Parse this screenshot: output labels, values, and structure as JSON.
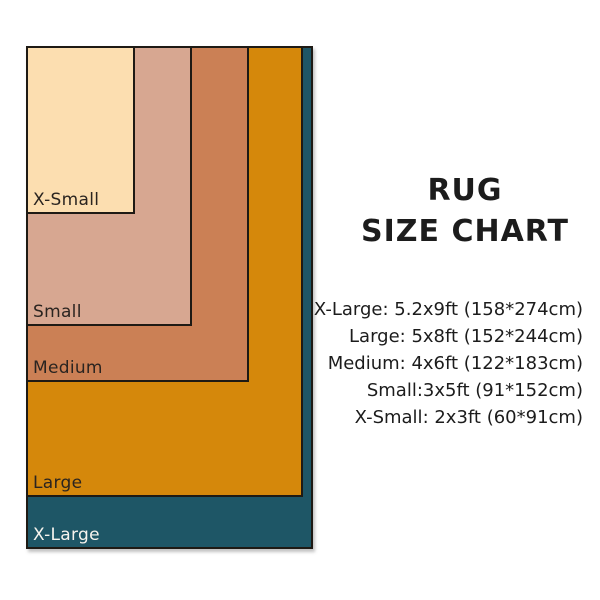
{
  "background": "#ffffff",
  "border_color": "#1e1a14",
  "text_color": "#1c1c1c",
  "title": {
    "line1": "RUG",
    "line2": "SIZE CHART"
  },
  "rugs": [
    {
      "label": "X-Large",
      "fill": "#1E5666",
      "label_color": "#F7F4EE",
      "x": 26,
      "y": 46,
      "w": 287,
      "h": 503
    },
    {
      "label": "Large",
      "fill": "#D5880B",
      "label_color": "#2A2420",
      "x": 26,
      "y": 46,
      "w": 277,
      "h": 451
    },
    {
      "label": "Medium",
      "fill": "#CB8055",
      "label_color": "#2A2420",
      "x": 26,
      "y": 46,
      "w": 223,
      "h": 336
    },
    {
      "label": "Small",
      "fill": "#D7A791",
      "label_color": "#2A2420",
      "x": 26,
      "y": 46,
      "w": 166,
      "h": 280
    },
    {
      "label": "X-Small",
      "fill": "#FCDEB0",
      "label_color": "#2A2420",
      "x": 26,
      "y": 46,
      "w": 109,
      "h": 168
    }
  ],
  "specs": [
    "X-Large: 5.2x9ft (158*274cm)",
    "Large: 5x8ft (152*244cm)",
    "Medium: 4x6ft (122*183cm)",
    "Small:3x5ft (91*152cm)",
    "X-Small: 2x3ft (60*91cm)"
  ],
  "chart_data": {
    "type": "area",
    "title": "RUG SIZE CHART",
    "categories": [
      "X-Small",
      "Small",
      "Medium",
      "Large",
      "X-Large"
    ],
    "series": [
      {
        "name": "width_ft",
        "values": [
          2,
          3,
          4,
          5,
          5.2
        ]
      },
      {
        "name": "length_ft",
        "values": [
          3,
          5,
          6,
          8,
          9
        ]
      },
      {
        "name": "width_cm",
        "values": [
          60,
          91,
          122,
          152,
          158
        ]
      },
      {
        "name": "length_cm",
        "values": [
          91,
          152,
          183,
          244,
          274
        ]
      }
    ],
    "legend_position": "none",
    "grid": false
  }
}
